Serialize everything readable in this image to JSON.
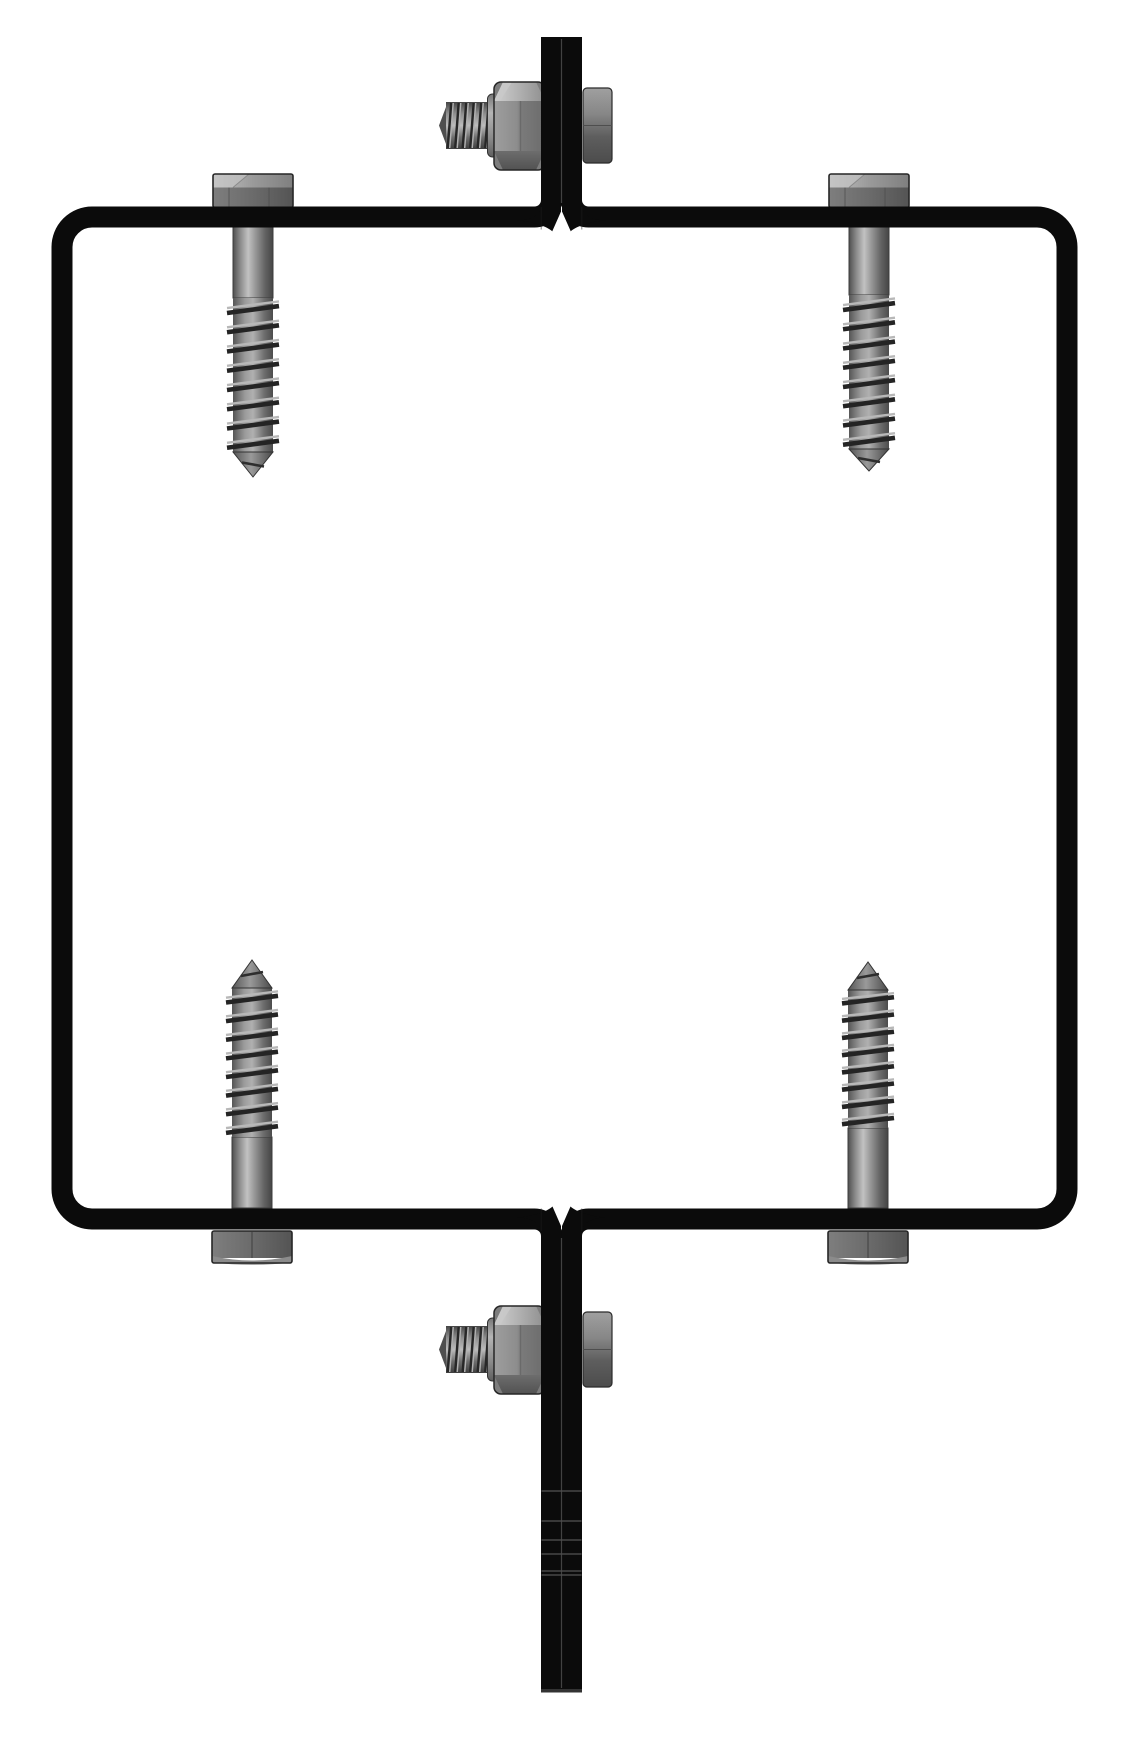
{
  "diagram": {
    "description": "Assembly drawing of a square wall-mount mast bracket: black tubular frame with upper and lower mast sections clamped by through-bolts at top and bottom center, and four lag screws at the corners",
    "background": "#ffffff",
    "palette": {
      "frame_black": "#0b0b0b",
      "steel_light": "#c2c2c2",
      "steel_mid": "#8a8a8a",
      "steel_dark": "#4a4a4a",
      "outline": "#262626",
      "seam_gray": "#424242",
      "white": "#ffffff"
    },
    "frame": {
      "name": "mounting-frame",
      "cl_left": 62,
      "cl_top": 217,
      "cl_right": 1067,
      "cl_bottom": 1219,
      "bar_cl_left": 551.5,
      "bar_cl_right": 571.5,
      "bar_top": 37,
      "bar_bottom": 1692,
      "fillet_r": 17,
      "corner_r": 30,
      "stroke": 21,
      "seam_x": 561.5
    },
    "mast": {
      "upper": {
        "name": "mast-upper-section",
        "seam_top": 39,
        "seam_bottom": 203
      },
      "lower": {
        "name": "mast-lower-section",
        "seam_top": 1238,
        "seam_bottom": 1688,
        "joint_lines": [
          1491,
          1521,
          1540,
          1554,
          1571,
          1575
        ],
        "end_cap_y": 1689
      }
    },
    "junctions": {
      "top": {
        "name": "frame-mast-junction-top",
        "v_tip_y": 210.5,
        "v_base_y": 233
      },
      "bottom": {
        "name": "frame-mast-junction-bottom",
        "v_tip_y": 1225.5,
        "v_base_y": 1203
      }
    },
    "lag_screw_geometry": {
      "head_w": 80,
      "head_h": 33,
      "shank_w": 40,
      "thread_spur_w": 52,
      "bands": 8
    },
    "lag_screws": [
      {
        "name": "lag-screw-top-left",
        "cx": 253,
        "direction": "down",
        "head_y": 174,
        "shank_y": [
          227,
          298
        ],
        "thread_y": [
          298,
          452
        ],
        "tip_y": 477
      },
      {
        "name": "lag-screw-top-right",
        "cx": 869,
        "direction": "down",
        "head_y": 174,
        "shank_y": [
          227,
          295
        ],
        "thread_y": [
          295,
          449
        ],
        "tip_y": 471
      },
      {
        "name": "lag-screw-bottom-left",
        "cx": 252,
        "direction": "up",
        "head_y": 1231,
        "shank_y": [
          1137,
          1208
        ],
        "thread_y": [
          988,
          1137
        ],
        "tip_y": 960
      },
      {
        "name": "lag-screw-bottom-right",
        "cx": 868,
        "direction": "up",
        "head_y": 1231,
        "shank_y": [
          1128,
          1208
        ],
        "thread_y": [
          990,
          1128
        ],
        "tip_y": 962
      }
    ],
    "bolt_geometry": {
      "stud": {
        "x": [
          446,
          491
        ],
        "y": [
          102,
          149
        ],
        "ridges": 6,
        "tip_x": 439
      },
      "collar": {
        "x": [
          487.5,
          501
        ],
        "y": [
          94,
          157
        ]
      },
      "nut": {
        "x": [
          494,
          545
        ],
        "y": [
          82,
          170
        ],
        "chamfer_y": [
          101,
          151
        ]
      },
      "head": {
        "x": [
          583,
          612
        ],
        "y": [
          88,
          163
        ]
      }
    },
    "clamp_bolts": [
      {
        "name": "clamp-bolt-top",
        "dy": 0
      },
      {
        "name": "clamp-bolt-bottom",
        "dy": 1224
      }
    ]
  }
}
